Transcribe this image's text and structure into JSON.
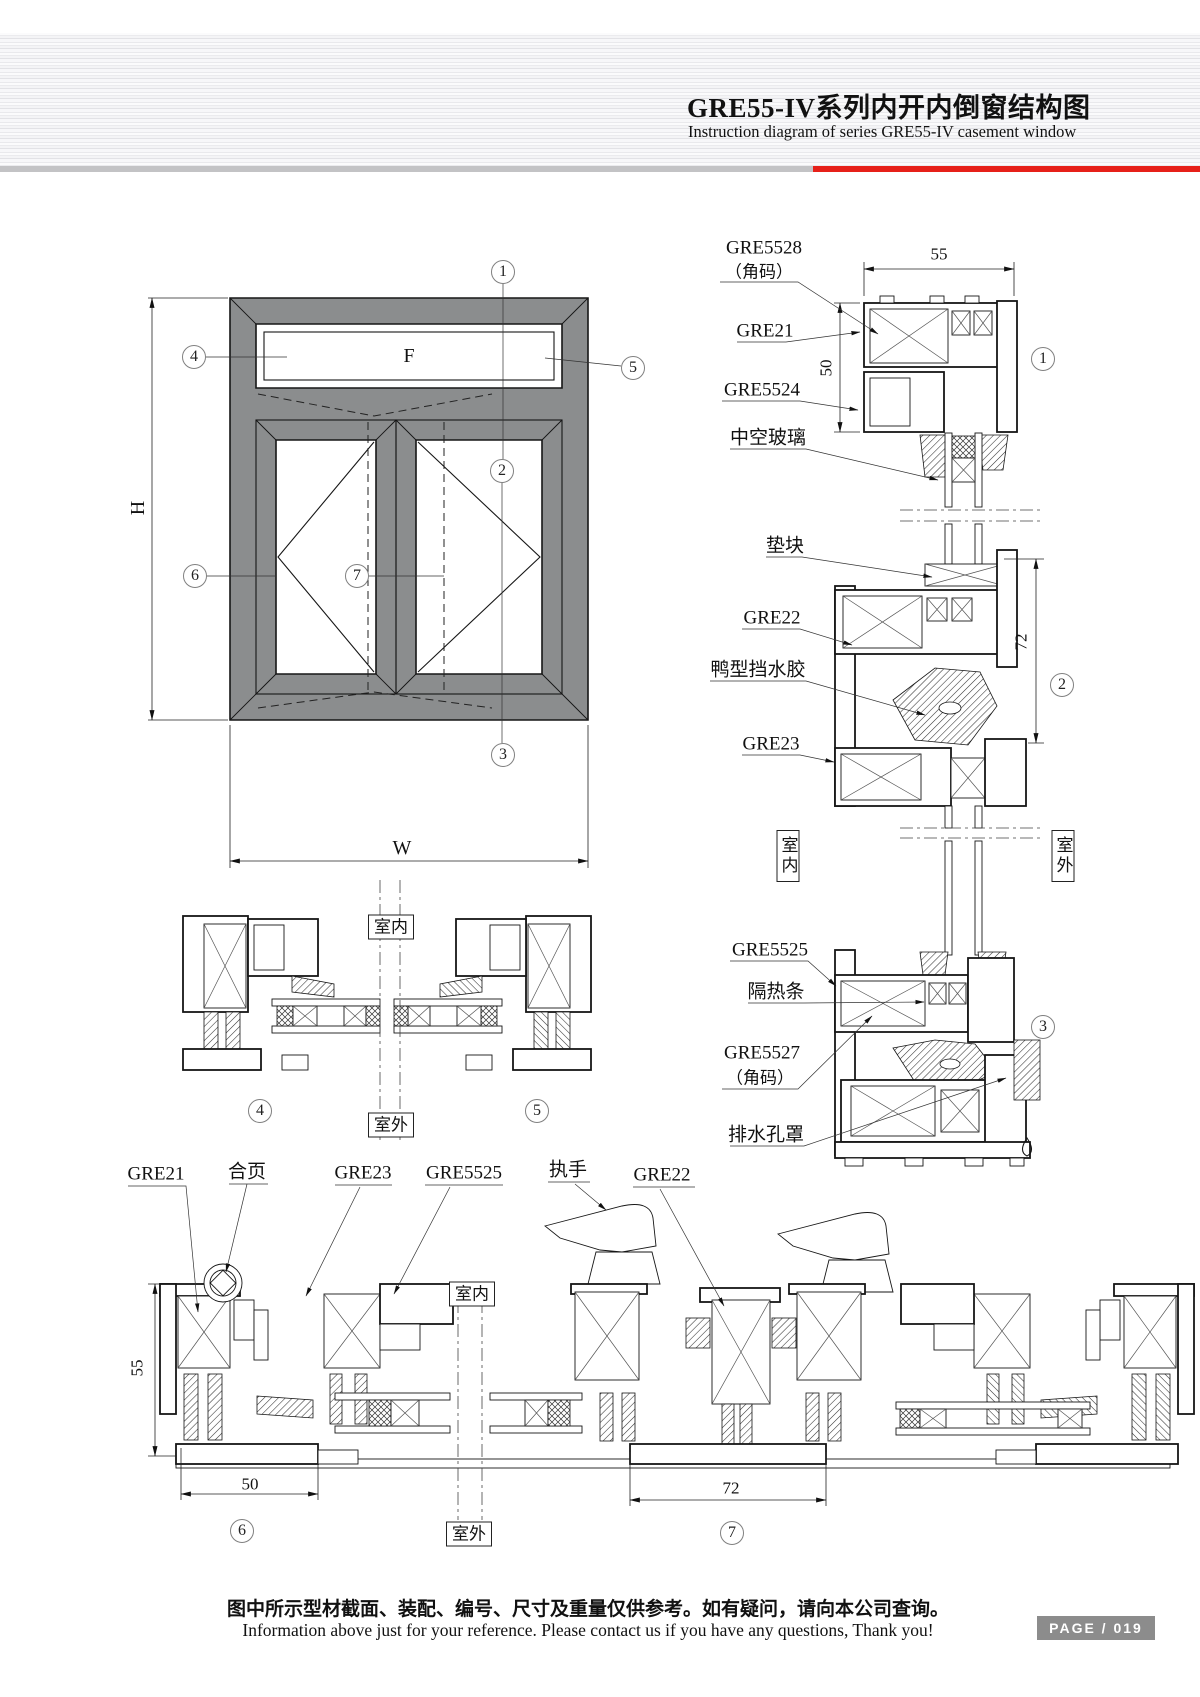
{
  "header": {
    "title_zh": "GRE55-IV系列内开内倒窗结构图",
    "title_en": "Instruction diagram of series GRE55-IV casement window"
  },
  "elevation": {
    "dim_height": "H",
    "dim_width": "W",
    "fixed_panel": "F",
    "callouts": {
      "top": "1",
      "upper_left": "4",
      "upper_right": "5",
      "middle": "2",
      "left": "6",
      "center": "7",
      "bottom": "3"
    }
  },
  "right_sections": {
    "labels": {
      "gre5528": "GRE5528",
      "gre5528_note": "（角码）",
      "gre21": "GRE21",
      "gre5524": "GRE5524",
      "insulating_glass": "中空玻璃",
      "setting_block": "垫块",
      "gre22": "GRE22",
      "water_baffle": "鸭型挡水胶",
      "gre23": "GRE23",
      "gre5525": "GRE5525",
      "thermal_strip": "隔热条",
      "gre5527": "GRE5527",
      "gre5527_note": "（角码）",
      "drain_cover": "排水孔罩"
    },
    "dims": {
      "width_top": "55",
      "height_left": "50",
      "height_right": "72"
    },
    "callouts": {
      "s1": "1",
      "s2": "2",
      "s3": "3"
    },
    "indoor": "室内",
    "outdoor": "室外"
  },
  "mid_sections": {
    "indoor": "室内",
    "outdoor": "室外",
    "callouts": {
      "s4": "4",
      "s5": "5"
    }
  },
  "bottom_section": {
    "labels": {
      "gre21": "GRE21",
      "hinge": "合页",
      "gre23": "GRE23",
      "gre5525": "GRE5525",
      "handle": "执手",
      "gre22": "GRE22"
    },
    "dims": {
      "height_left": "55",
      "width_left": "50",
      "width_center": "72"
    },
    "callouts": {
      "s6": "6",
      "s7": "7"
    },
    "indoor": "室内",
    "outdoor": "室外"
  },
  "footer": {
    "note_zh": "图中所示型材截面、装配、编号、尺寸及重量仅供参考。如有疑问，请向本公司查询。",
    "note_en": "Information above just for your reference. Please contact us if you have any questions, Thank you!",
    "page_label": "PAGE / 019"
  }
}
